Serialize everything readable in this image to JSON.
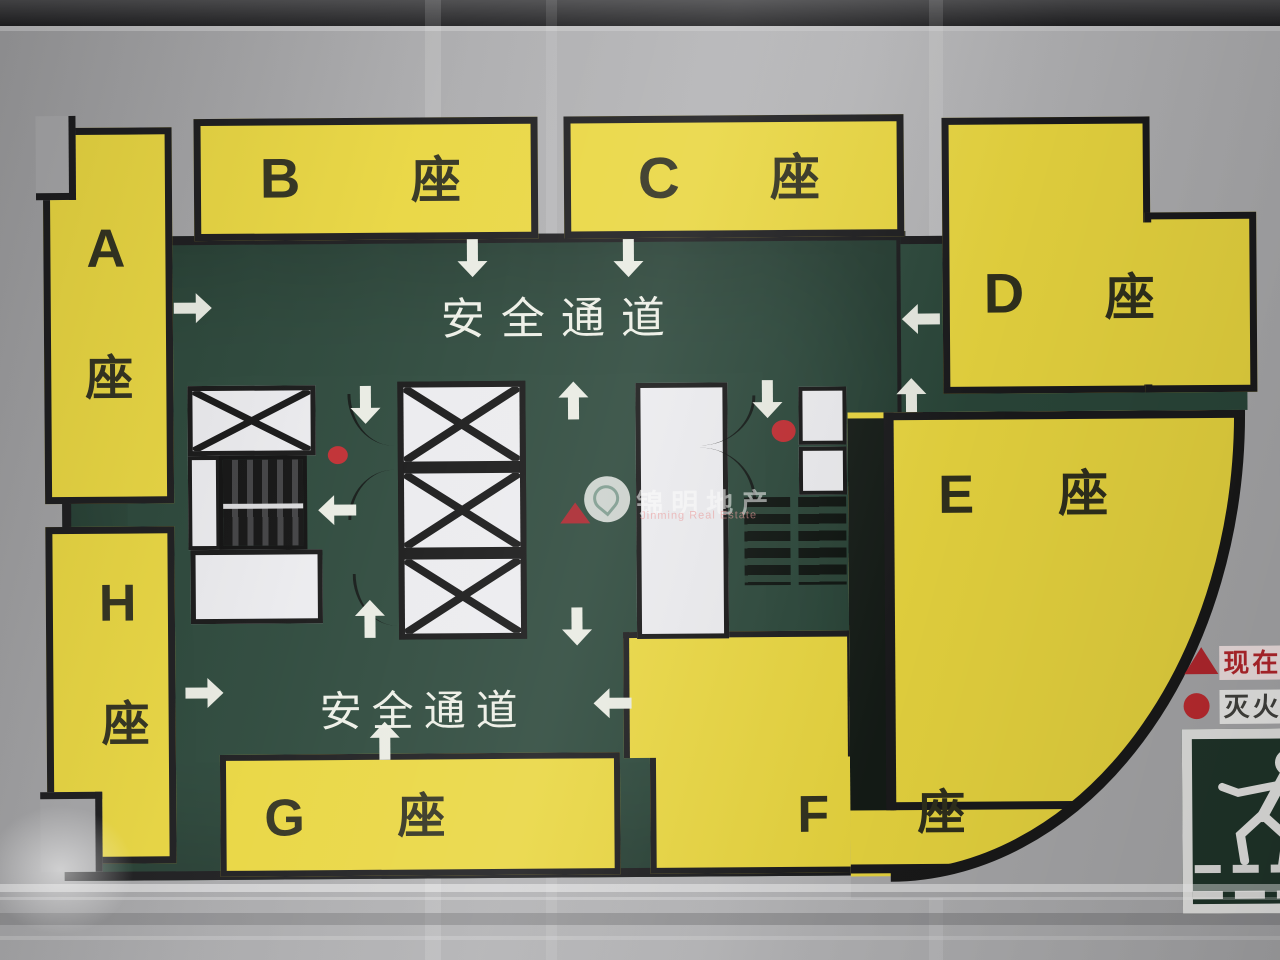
{
  "photo": {
    "type": "building-evacuation-floor-plan-sign",
    "corridor_top_label": "安全通道",
    "corridor_bottom_label": "安全通道",
    "blocks": {
      "a": {
        "letter": "A",
        "suffix": "座"
      },
      "b": {
        "letter": "B",
        "suffix": "座"
      },
      "c": {
        "letter": "C",
        "suffix": "座"
      },
      "d": {
        "letter": "D",
        "suffix": "座"
      },
      "e": {
        "letter": "E",
        "suffix": "座"
      },
      "f": {
        "letter": "F",
        "suffix": "座"
      },
      "g": {
        "letter": "G",
        "suffix": "座"
      },
      "h": {
        "letter": "H",
        "suffix": "座"
      }
    },
    "legend": {
      "current_position_label": "现在位置",
      "fire_extinguisher_label": "灭火器"
    },
    "watermark": {
      "cn": "锦明地产",
      "en": "Jinming Real Estate"
    },
    "icons": {
      "exit_sign": "running-man-down-stairs-icon",
      "current_position_marker": "red-triangle",
      "fire_extinguisher_marker": "red-dot"
    },
    "colors": {
      "block_yellow": "#e9d63f",
      "corridor_green": "#2a4639",
      "frame_black": "#1a1a1c",
      "arrow_white": "#e9ebe2",
      "marker_red": "#bf2b30",
      "metal_gray": "#a8a8aa"
    }
  }
}
